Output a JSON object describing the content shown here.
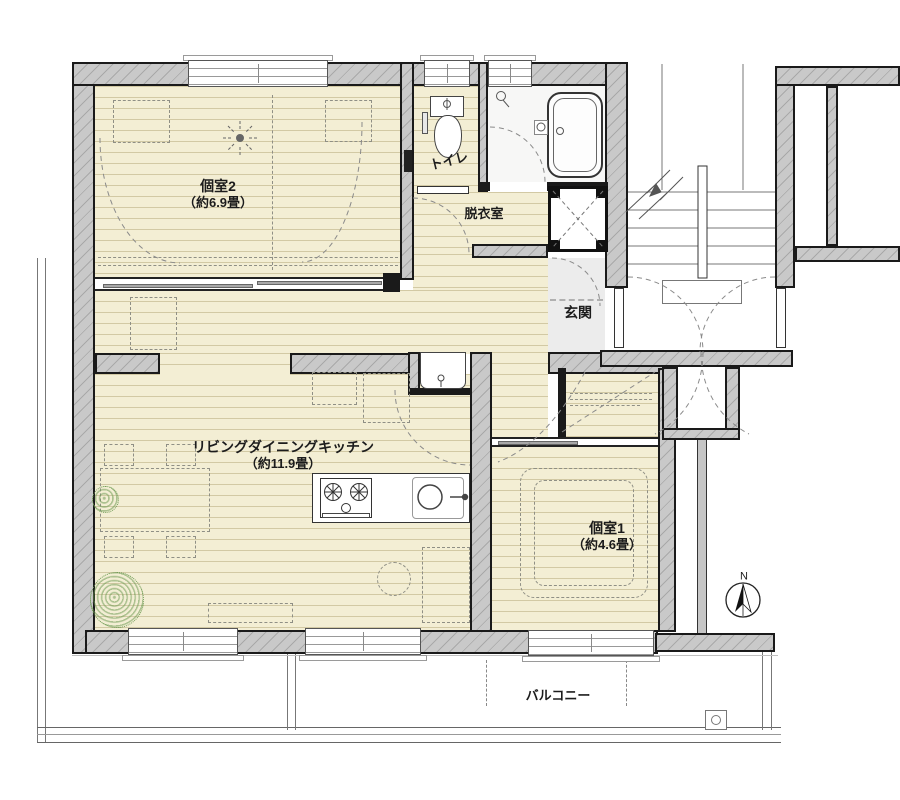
{
  "rooms": {
    "room2": {
      "name": "個室2",
      "size": "（約6.9畳）"
    },
    "toilet": {
      "name": "トイレ"
    },
    "washroom": {
      "name": "脱衣室"
    },
    "entrance": {
      "name": "玄関"
    },
    "ldk": {
      "name": "リビングダイニングキッチン",
      "size": "（約11.9畳）"
    },
    "room1": {
      "name": "個室1",
      "size": "（約4.6畳）"
    },
    "balcony": {
      "name": "バルコニー"
    }
  },
  "compass": {
    "north": "N"
  },
  "colors": {
    "floor": "#f3eed4",
    "floorline": "#d2c9a4",
    "wallfill": "#c9c9c9",
    "wallline": "#1a1a1a",
    "bathfloor": "#f7f7f6",
    "genkanfloor": "#ececec",
    "dash": "#8f8f85",
    "plant": "#6f9c55"
  }
}
